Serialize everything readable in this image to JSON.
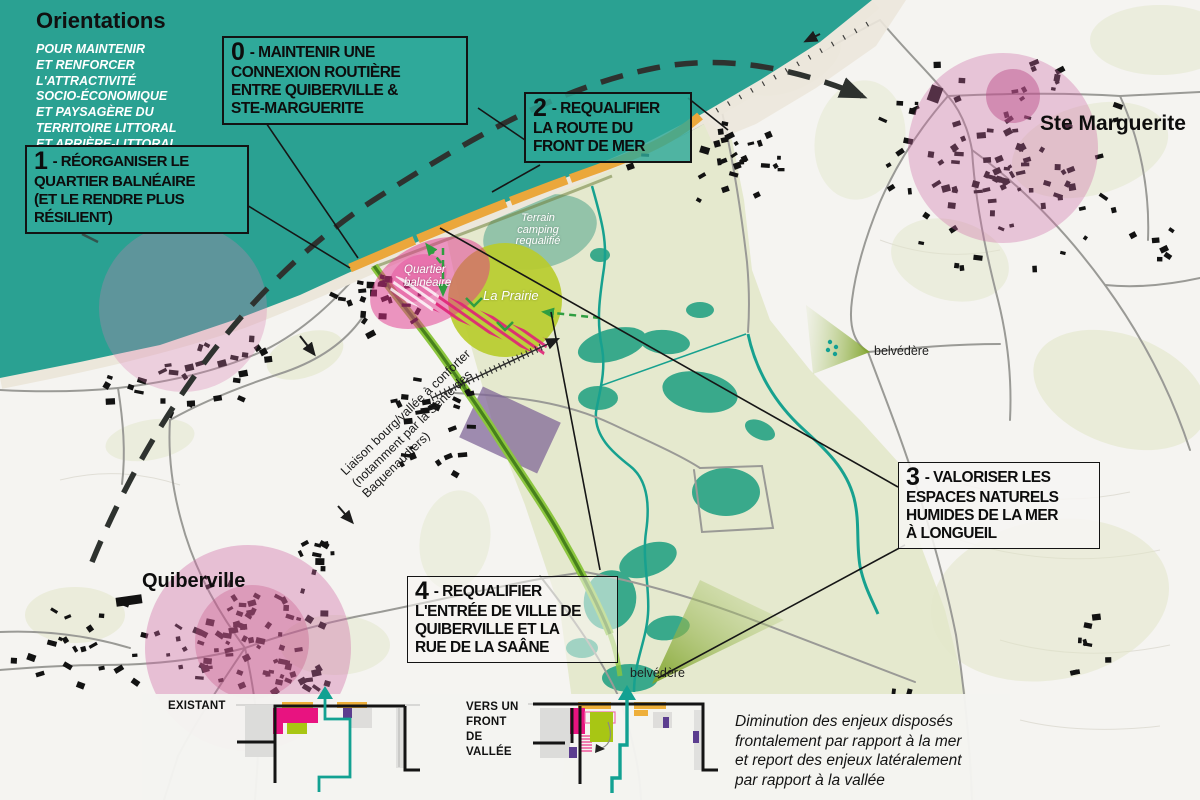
{
  "header": {
    "title": "Orientations",
    "subtitle": "POUR MAINTENIR\nET RENFORCER\nL'ATTRACTIVITÉ\nSOCIO-ÉCONOMIQUE\nET PAYSAGÈRE DU\nTERRITOIRE LITTORAL\nET ARRIÈRE-LITTORAL"
  },
  "orientation_boxes": [
    {
      "number": "0",
      "text": " - MAINTENIR UNE\nCONNEXION ROUTIÈRE\nENTRE QUIBERVILLE &\nSTE-MARGUERITE"
    },
    {
      "number": "1",
      "text": " - RÉORGANISER LE\nQUARTIER BALNÉAIRE\n(ET LE RENDRE PLUS\nRÉSILIENT)"
    },
    {
      "number": "2",
      "text": " - REQUALIFIER\nLA ROUTE DU\nFRONT DE MER"
    },
    {
      "number": "3",
      "text": " - VALORISER LES\nESPACES NATURELS\nHUMIDES DE LA MER\nÀ LONGUEIL"
    },
    {
      "number": "4",
      "text": " - REQUALIFIER\nL'ENTRÉE DE VILLE DE\nQUIBERVILLE ET LA\nRUE DE LA SAÂNE"
    }
  ],
  "map_labels": {
    "town_ste_marguerite": "Ste Marguerite",
    "town_quiberville": "Quiberville",
    "belvedere_north": "belvédère",
    "belvedere_south": "belvédère",
    "quartier_balneaire": "Quartier\nbalnéaire",
    "la_prairie": "La Prairie",
    "camping": "Terrain\ncamping\nrequalifié",
    "liaison": "Liaison bourg/vallée à conforter\n(notamment par la Sente des\nBaquenaudiers)"
  },
  "legend": {
    "existant_label": "EXISTANT",
    "vallee_label": "VERS UN\nFRONT\nDE\nVALLÉE",
    "caption": "Diminution des enjeux disposés\nfrontalement par rapport à la mer\net report des enjeux latéralement\npar rapport à la vallée"
  },
  "palette": {
    "sea_teal": "#2aa192",
    "box_teal": "#2fa99a",
    "coast_route_orange": "#eba73b",
    "green_corridor": "#8cc63f",
    "green_corridor_core": "#47801c",
    "magenta_quartier": "#e2338d",
    "legend_magenta": "#e81380",
    "legend_lime": "#a8c614",
    "legend_purple": "#5b3d8f",
    "pink_halo": "#cf6aa5",
    "wetland_green": "#2ba486",
    "valley_green": "#e4e8cb",
    "teal_arrow": "#12a192",
    "dashed_arc_black": "#2e322f"
  }
}
